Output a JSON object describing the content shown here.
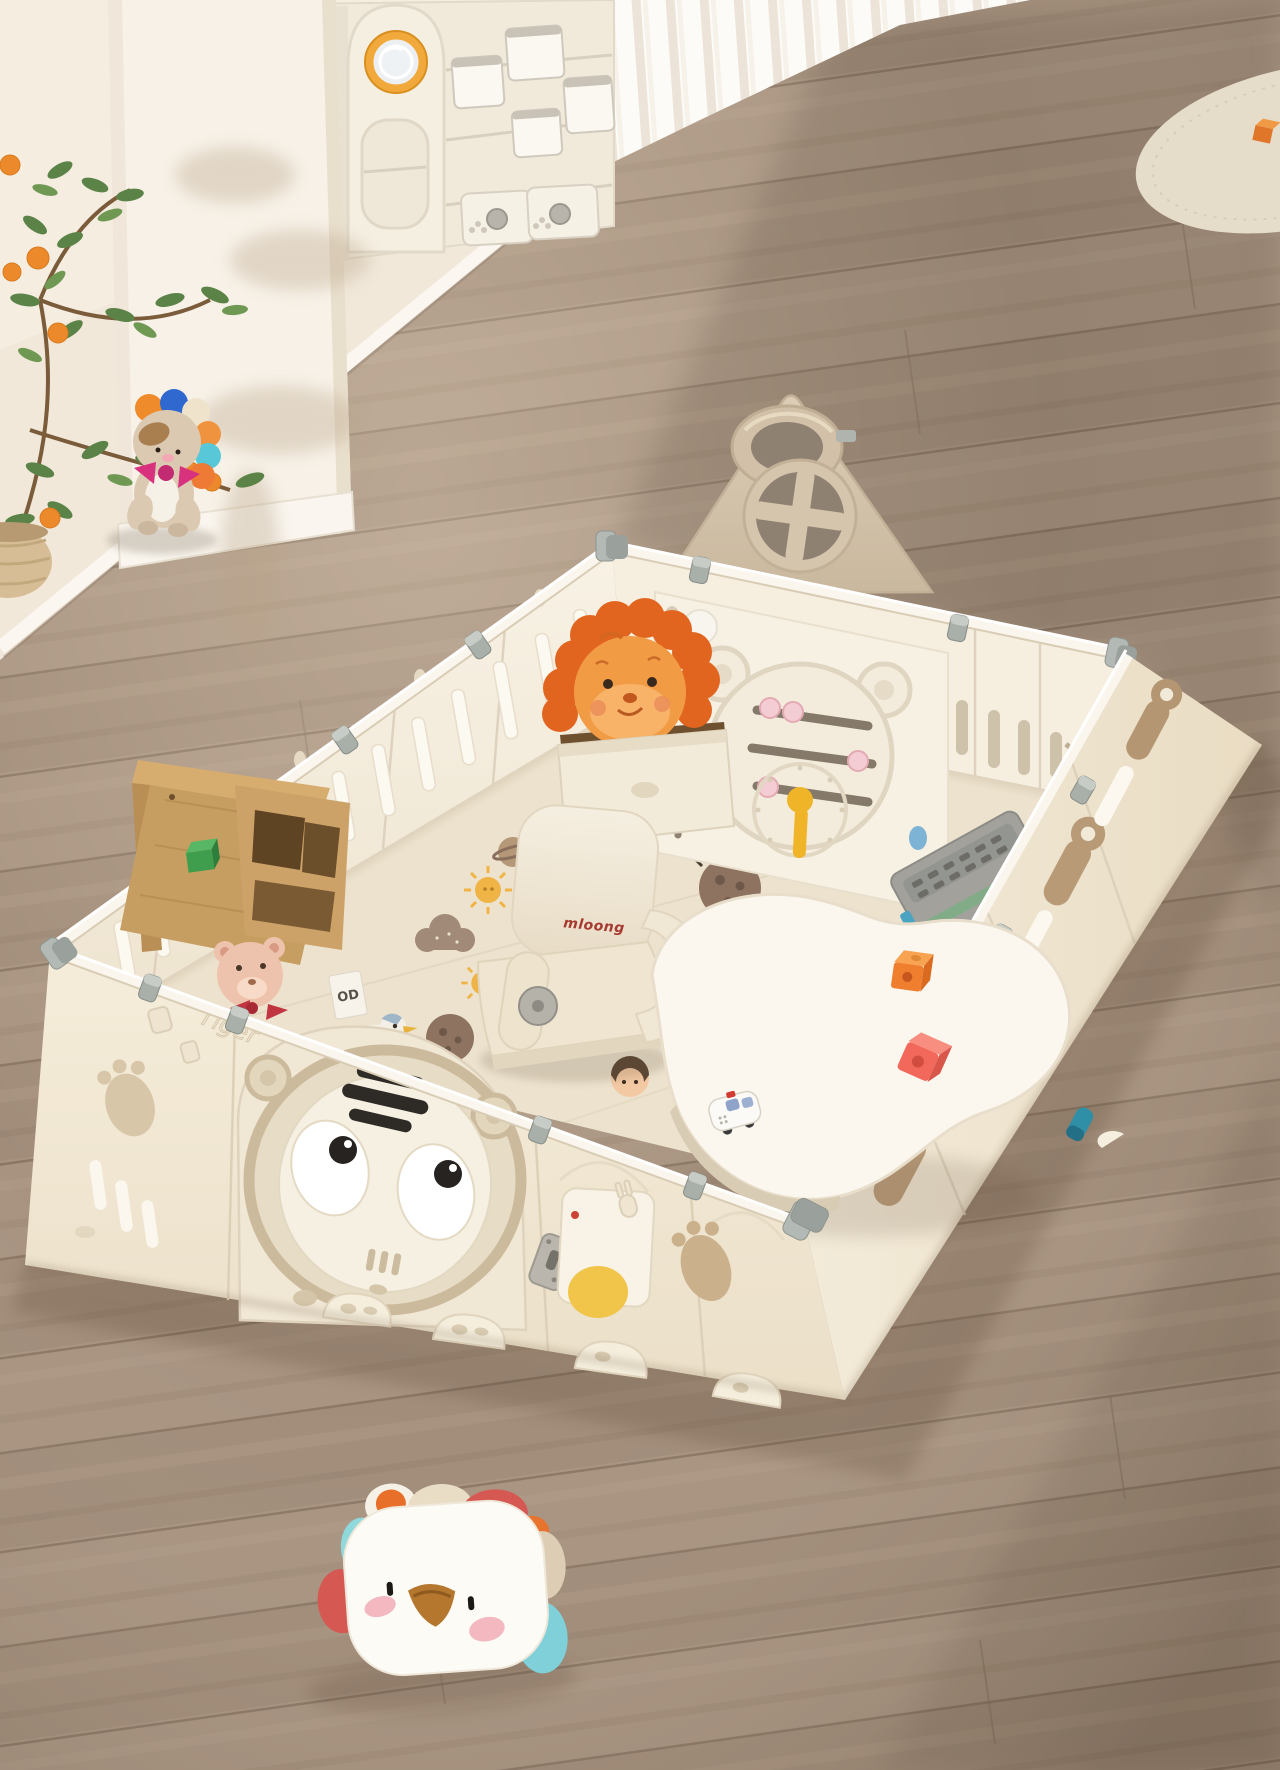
{
  "scene": {
    "description": "Overhead photo of a cream foldable baby playpen with a tiger-face gate, bear activity panel and basketball-hoop roof panel on wood flooring; inside are a printed play mat, kids chair, bean-shaped white table, toy car, blocks, a storage box with a plush lion and a wooden bookshelf; around it are a plush lion, a bird-face pillow, a fruit tree plant, toy storage shelves and sheer curtains.",
    "texts": {
      "chair_brand": "mloong",
      "panel_script": "Tiger",
      "shelf_book": "OD"
    },
    "palette": {
      "floor_wood": "#a4907d",
      "floor_dark": "#7c6a5c",
      "wall_cream": "#f1e8da",
      "panel_white": "#f4ecdc",
      "panel_tan": "#b89b79",
      "roof_tan": "#d3c3ab",
      "clip_gray": "#a9afa9",
      "mat_cream": "#ece2cd",
      "mat_taupe": "#a18a77",
      "sun_yellow": "#efb445",
      "lion_orange": "#f29b45",
      "mane_orange": "#e2651f",
      "bow_pink": "#d8327f",
      "mane_blue": "#2f68cf",
      "mane_teal": "#58c8d8",
      "pillow_red": "#d65852",
      "pillow_teal": "#8fd8dc",
      "beak_brown": "#b5762d",
      "brand_red": "#a63a30",
      "block_orange": "#ef7e2e",
      "block_coral": "#f2685a",
      "block_green": "#3f9e4d",
      "wheel_teal": "#2f8fa7",
      "plant_green": "#5c8347",
      "fruit_orange": "#ec8a2b",
      "clock_yellow": "#f0b429",
      "bead_pink": "#f3cdd3",
      "stripe_black": "#2e2b27"
    }
  }
}
